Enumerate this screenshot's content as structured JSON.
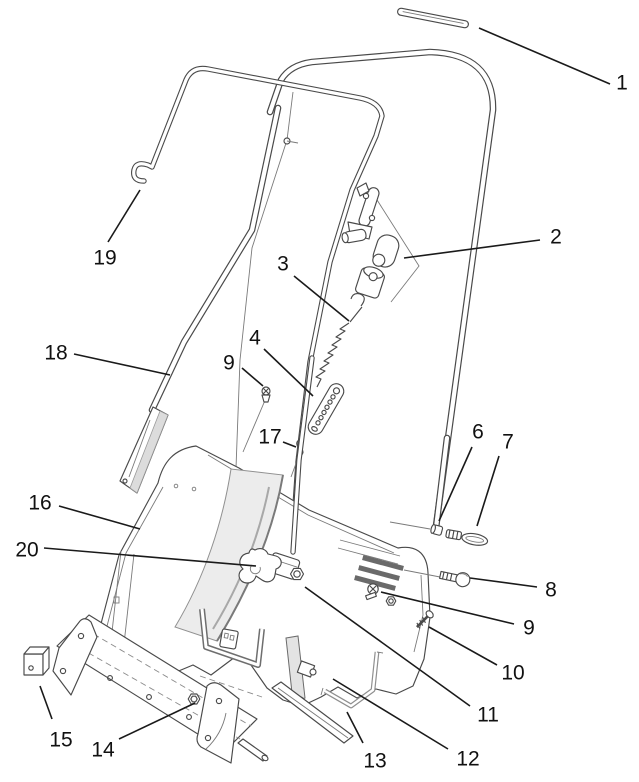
{
  "diagram": {
    "background": "#ffffff",
    "line_color": "#4a4a4a",
    "leader_color": "#1a1a1a",
    "label_color": "#111111",
    "panel_shade": "#ececec",
    "vent_color": "#6a6a6a"
  },
  "callouts": [
    {
      "id": "1",
      "number": "1",
      "tx": 622,
      "ty": 82,
      "x1": 479,
      "y1": 28,
      "x2": 610,
      "y2": 84
    },
    {
      "id": "2",
      "number": "2",
      "tx": 556,
      "ty": 236,
      "x1": 404,
      "y1": 258,
      "x2": 540,
      "y2": 240
    },
    {
      "id": "3",
      "number": "3",
      "tx": 283,
      "ty": 263,
      "x1": 294,
      "y1": 276,
      "x2": 349,
      "y2": 321
    },
    {
      "id": "4",
      "number": "4",
      "tx": 255,
      "ty": 337,
      "x1": 264,
      "y1": 349,
      "x2": 313,
      "y2": 396
    },
    {
      "id": "6",
      "number": "6",
      "tx": 478,
      "ty": 431,
      "x1": 472,
      "y1": 447,
      "x2": 439,
      "y2": 521
    },
    {
      "id": "7",
      "number": "7",
      "tx": 508,
      "ty": 441,
      "x1": 499,
      "y1": 456,
      "x2": 477,
      "y2": 526
    },
    {
      "id": "8",
      "number": "8",
      "tx": 551,
      "ty": 589,
      "x1": 537,
      "y1": 587,
      "x2": 470,
      "y2": 578
    },
    {
      "id": "9-right",
      "number": "9",
      "tx": 529,
      "ty": 627,
      "x1": 514,
      "y1": 624,
      "x2": 381,
      "y2": 592
    },
    {
      "id": "10",
      "number": "10",
      "tx": 513,
      "ty": 672,
      "x1": 497,
      "y1": 665,
      "x2": 429,
      "y2": 627
    },
    {
      "id": "11",
      "number": "11",
      "tx": 488,
      "ty": 714,
      "x1": 470,
      "y1": 706,
      "x2": 305,
      "y2": 587
    },
    {
      "id": "12",
      "number": "12",
      "tx": 468,
      "ty": 758,
      "x1": 448,
      "y1": 749,
      "x2": 333,
      "y2": 679
    },
    {
      "id": "13",
      "number": "13",
      "tx": 375,
      "ty": 760,
      "x1": 363,
      "y1": 743,
      "x2": 347,
      "y2": 712
    },
    {
      "id": "14",
      "number": "14",
      "tx": 103,
      "ty": 749,
      "x1": 119,
      "y1": 739,
      "x2": 195,
      "y2": 703
    },
    {
      "id": "15",
      "number": "15",
      "tx": 61,
      "ty": 739,
      "x1": 52,
      "y1": 719,
      "x2": 40,
      "y2": 686
    },
    {
      "id": "16",
      "number": "16",
      "tx": 40,
      "ty": 502,
      "x1": 59,
      "y1": 506,
      "x2": 140,
      "y2": 529
    },
    {
      "id": "17",
      "number": "17",
      "tx": 270,
      "ty": 436,
      "x1": 283,
      "y1": 442,
      "x2": 296,
      "y2": 447
    },
    {
      "id": "18",
      "number": "18",
      "tx": 56,
      "ty": 352,
      "x1": 74,
      "y1": 354,
      "x2": 170,
      "y2": 375
    },
    {
      "id": "19",
      "number": "19",
      "tx": 105,
      "ty": 257,
      "x1": 108,
      "y1": 242,
      "x2": 140,
      "y2": 190
    },
    {
      "id": "20",
      "number": "20",
      "tx": 27,
      "ty": 549,
      "x1": 44,
      "y1": 548,
      "x2": 256,
      "y2": 566
    },
    {
      "id": "9-left",
      "number": "9",
      "tx": 229,
      "ty": 362,
      "x1": 242,
      "y1": 368,
      "x2": 263,
      "y2": 386
    }
  ]
}
